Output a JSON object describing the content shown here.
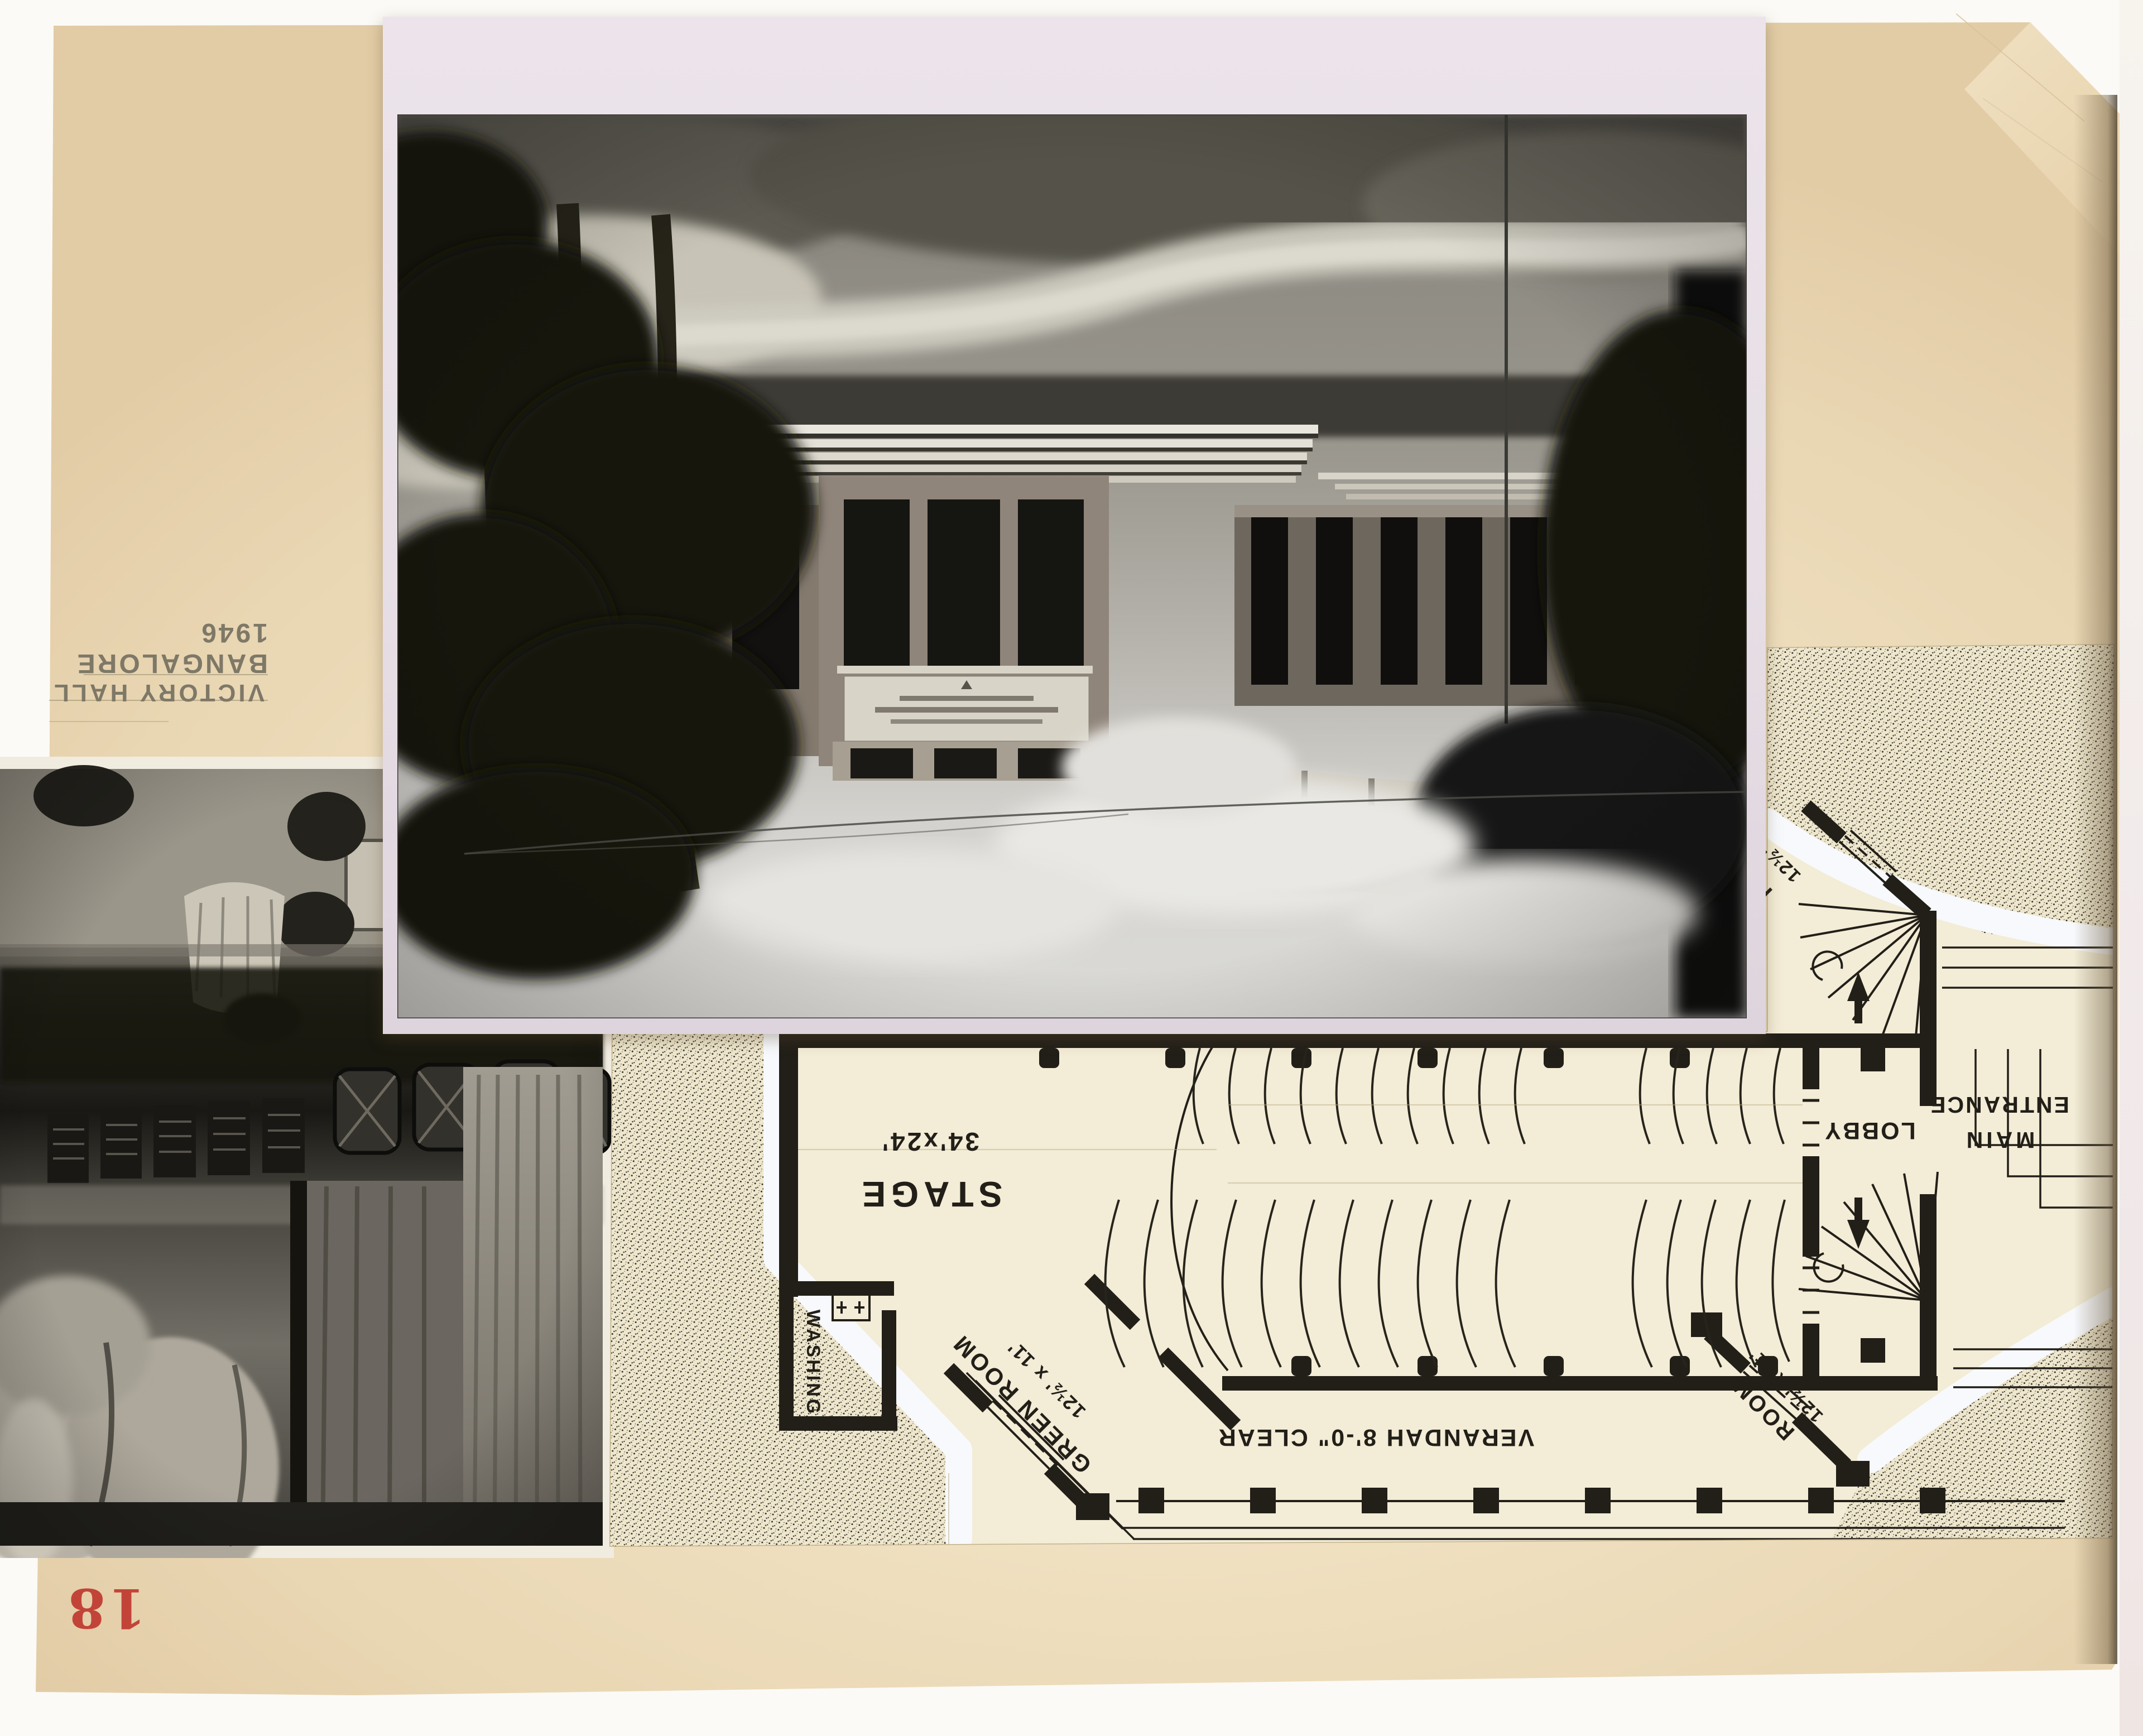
{
  "album_page": {
    "page_number_stamp": "18",
    "caption": {
      "line1": "VICTORY HALL",
      "line2": "BANGALORE 1946"
    }
  },
  "floor_plan": {
    "labels": {
      "stage": "STAGE",
      "stage_size": "34'x24'",
      "verandah": "VERANDAH 8'-0\" CLEAR",
      "green_room": "GREEN ROOM",
      "green_room_size": "12½' x 11'",
      "washing": "WASHING",
      "lobby": "LOBBY",
      "main_entrance_line1": "MAIN",
      "main_entrance_line2": "ENTRANCE",
      "room_northeast": "ROOM",
      "room_northeast_size": "12½' x 11'",
      "room_southeast": "ROOM",
      "room_southeast_size": "12½' x 11'"
    }
  },
  "colors": {
    "page_tan": "#edddbc",
    "photo_mat_pink": "#e8dfe7",
    "plan_paper_cream": "#f3ecd6",
    "plan_ink": "#221f19",
    "stamp_red": "#c03a31",
    "pencil_gray": "#7e7867",
    "gouache_white": "#f7f9fc"
  }
}
